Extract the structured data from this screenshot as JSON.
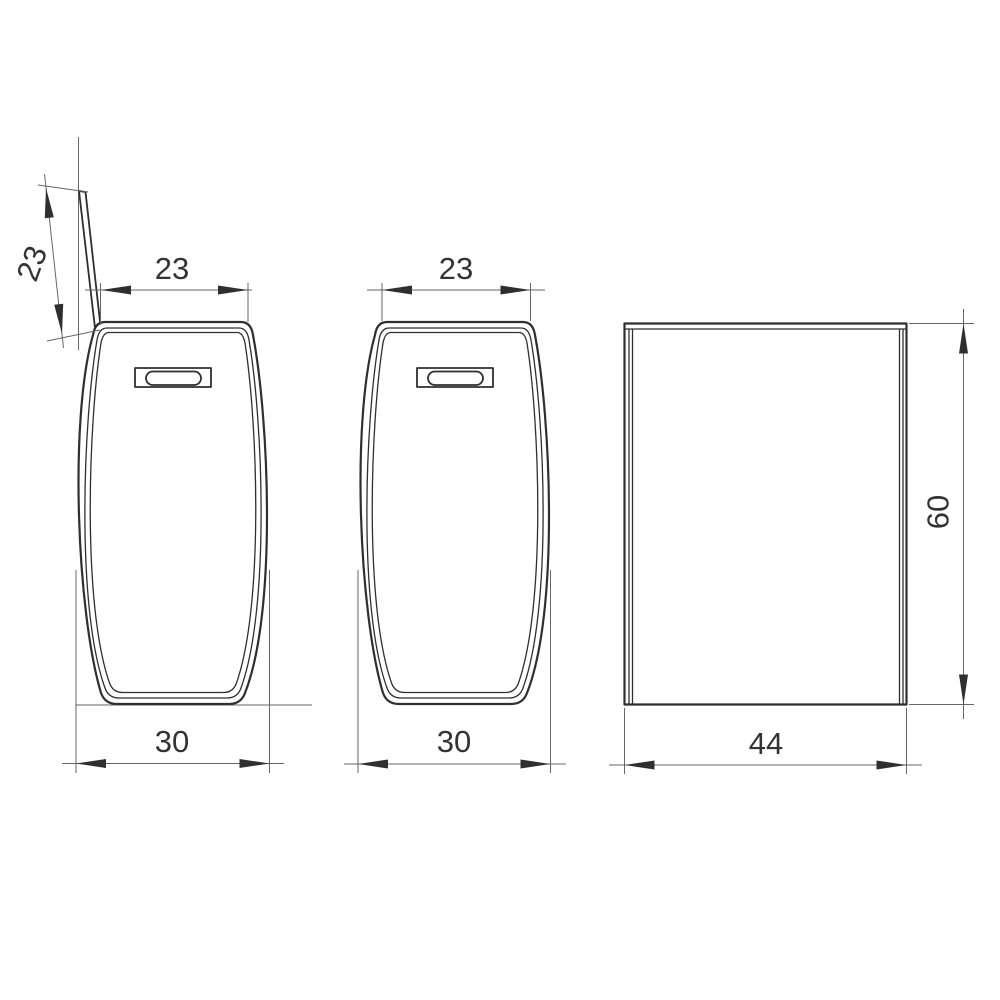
{
  "title": "Technical drawing of a storage bin in three orthographic views",
  "canvas": {
    "width": 1000,
    "height": 1000
  },
  "style": {
    "background": "#ffffff",
    "outline_color": "#2f2f2f",
    "thin_line_color": "#666666",
    "text_color": "#333333"
  },
  "views": [
    {
      "id": "front-view-lid-open",
      "label": "front view with lid open",
      "dimensions": [
        {
          "id": "lid-depth",
          "value": "23"
        },
        {
          "id": "top-width",
          "value": "23"
        },
        {
          "id": "max-width",
          "value": "30"
        }
      ]
    },
    {
      "id": "front-view-lid-closed",
      "label": "front view with lid closed",
      "dimensions": [
        {
          "id": "top-width",
          "value": "23"
        },
        {
          "id": "max-width",
          "value": "30"
        }
      ]
    },
    {
      "id": "side-view",
      "label": "side view",
      "dimensions": [
        {
          "id": "depth",
          "value": "44"
        },
        {
          "id": "height",
          "value": "60"
        }
      ]
    }
  ]
}
